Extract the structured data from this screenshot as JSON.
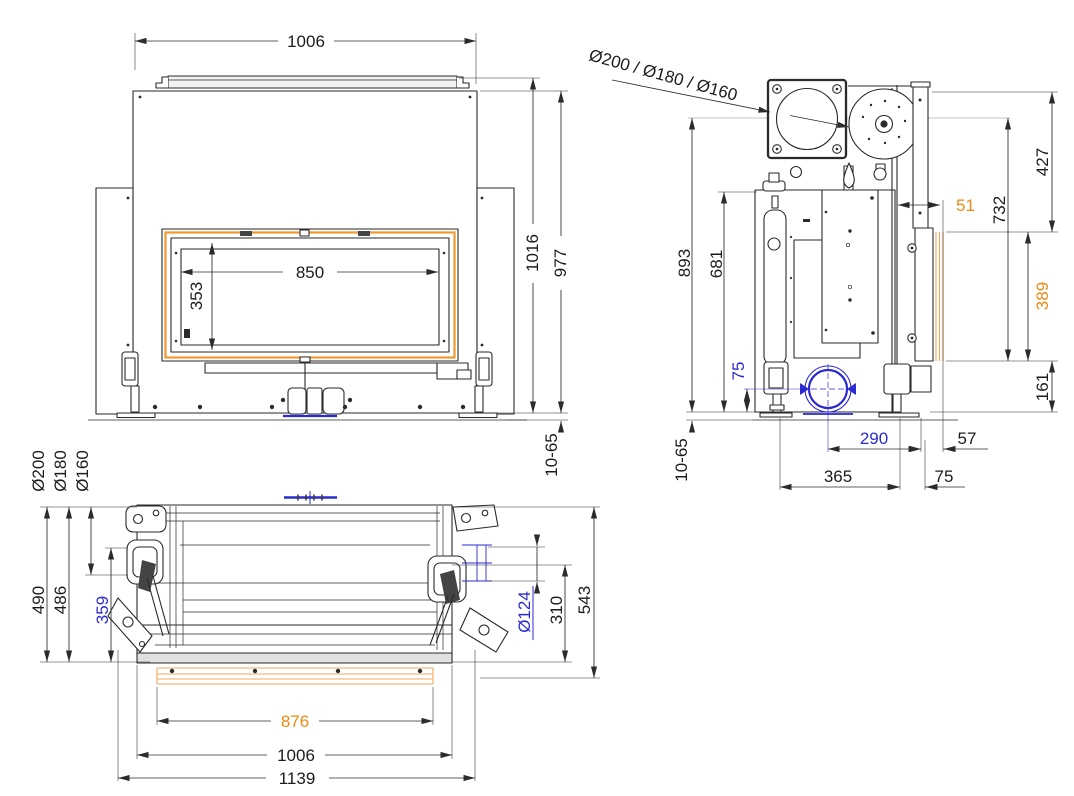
{
  "drawing": {
    "type": "technical-drawing-three-views",
    "colors": {
      "line": "#2a2a2a",
      "blue": "#2a2ad0",
      "orange": "#ef8a10",
      "orange_light": "#f2aa60"
    },
    "front_view": {
      "width": "1006",
      "glass_width": "850",
      "glass_height": "353",
      "height_total": "1016",
      "height_body": "977",
      "feet_range": "10-65"
    },
    "side_view": {
      "flue_options": "Ø200 / Ø180 / Ø160",
      "flue_center_height": "893",
      "body_height": "681",
      "air_inlet_height": "75",
      "feet_range": "10-65",
      "top_to_flue": "427",
      "flue_to_frame": "732",
      "frame_offset": "51",
      "frame_height": "389",
      "base_height": "161",
      "air_inlet_offset": "290",
      "front_gap": "57",
      "feet_depth": "365",
      "front_feet_gap": "75"
    },
    "top_view": {
      "flue_option_1": "Ø200",
      "flue_option_2": "Ø180",
      "flue_option_3": "Ø160",
      "depth_flue_200": "490",
      "depth_flue_180": "486",
      "air_inlet_depth": "359",
      "air_inlet_diameter": "Ø124",
      "front_depth": "310",
      "total_depth": "543",
      "grille_width": "876",
      "body_width": "1006",
      "total_width": "1139"
    }
  }
}
